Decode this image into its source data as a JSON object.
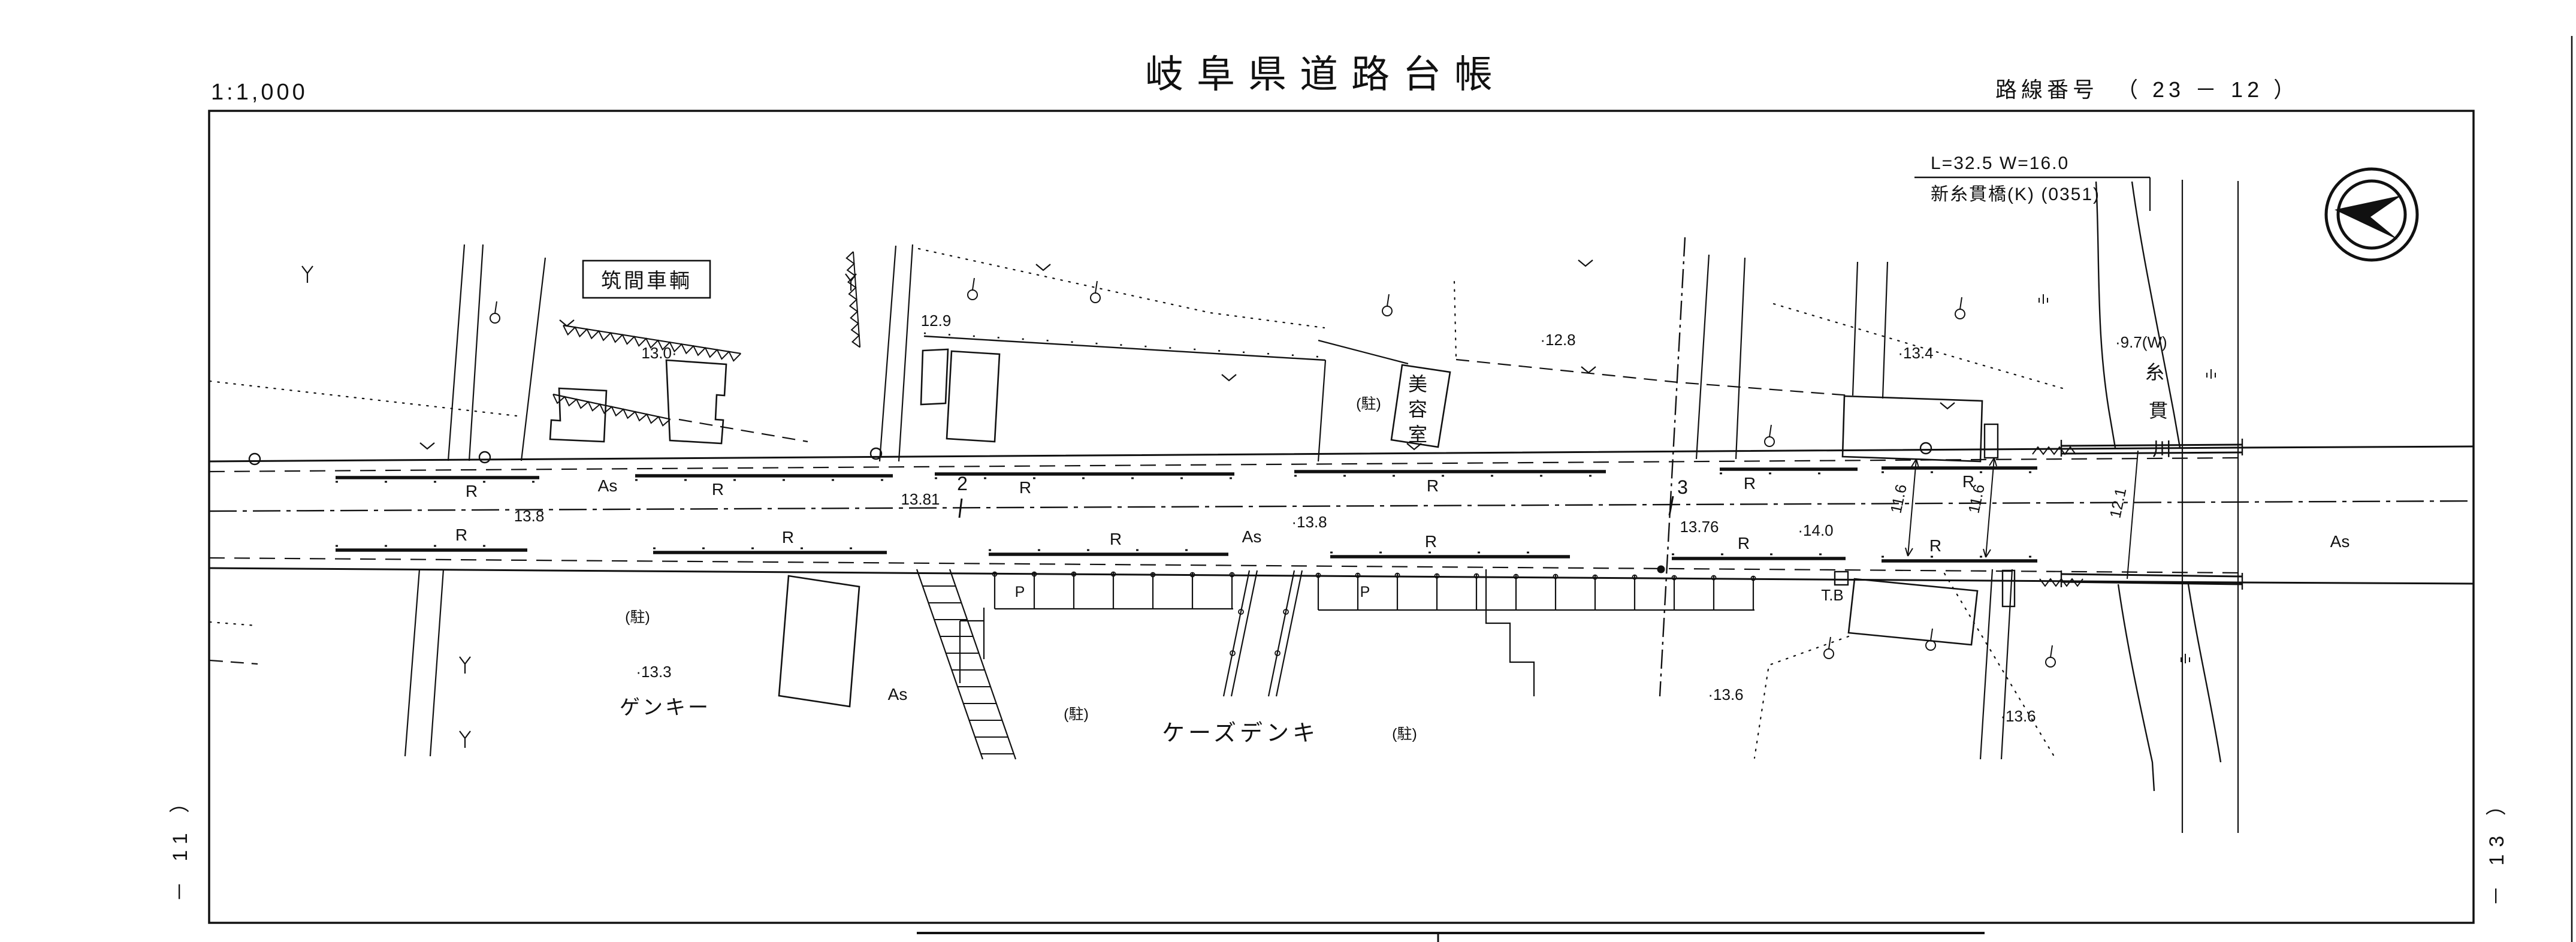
{
  "header": {
    "scale": "1:1,000",
    "title": "岐阜県道路台帳",
    "route_label": "路線番号",
    "route_value": "（ 23 － 12 ）"
  },
  "sheet_refs": {
    "left": "－ 11 ）",
    "right": "－ 13 ）"
  },
  "bridge": {
    "dimensions": "L=32.5  W=16.0",
    "name": "新糸貫橋(K) (0351)"
  },
  "river": {
    "name": "糸貫川",
    "chars": [
      "糸",
      "貫",
      "川"
    ],
    "width_note": "·9.7(W)"
  },
  "road": {
    "surface_label": "As",
    "curb_label": "R",
    "parking_label": "P",
    "parking_note": "(駐)",
    "telephone_box": "T.B"
  },
  "stations": {
    "s2": {
      "label": "2",
      "elevation": "13.81"
    },
    "s3": {
      "label": "3",
      "elevation": "13.76"
    }
  },
  "elevations": [
    "13.0·",
    "12.9",
    "·12.8",
    "·13.4",
    "·13.8",
    "13.8",
    "·14.0",
    "·13.3",
    "·13.6",
    "·13.6"
  ],
  "road_widths": [
    "11.6",
    "11.6",
    "12.1"
  ],
  "businesses": {
    "chikuma": "筑間車輌",
    "salon": "美容室",
    "salon_chars": [
      "美",
      "容",
      "室"
    ],
    "genky": "ゲンキー",
    "ksdenki": "ケーズデンキ"
  }
}
